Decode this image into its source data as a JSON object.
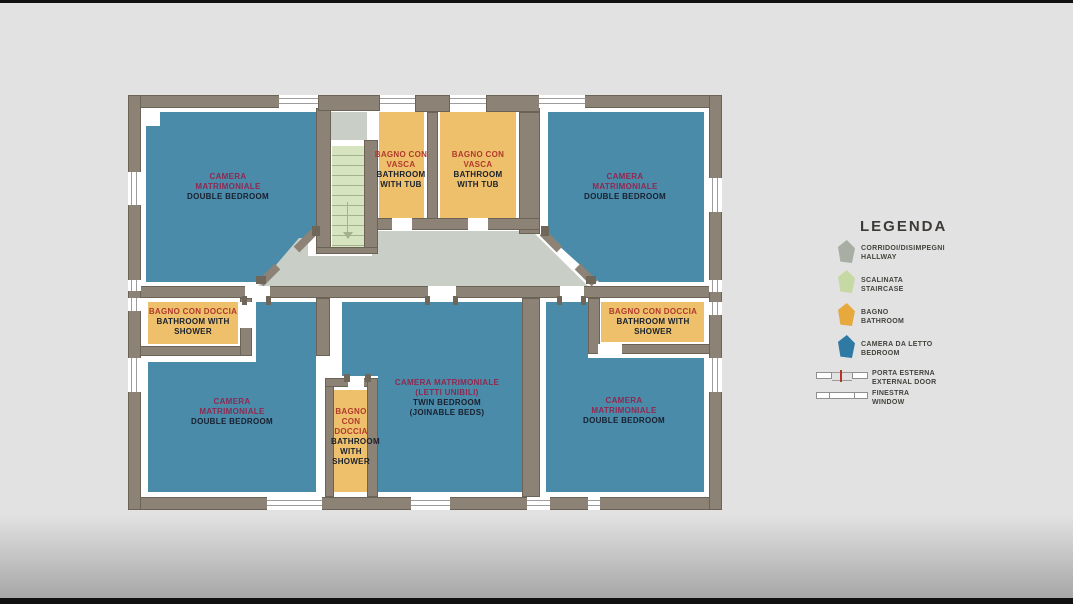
{
  "colors": {
    "bg": "#e2e2e2",
    "wall": "#8c8275",
    "wallline": "#6b6356",
    "bedroom": "#4b8baa",
    "bathroom": "#eec06c",
    "hallway": "#c9cfc7",
    "stair": "#d6e4c0",
    "stairline": "#a2b38d",
    "ink": "#18202e",
    "itblue": "#8e2950",
    "itorange": "#b03a2c",
    "legendink": "#45433e",
    "lghall": "#a8aea3",
    "lgstair": "#c6d9a4",
    "lgbath": "#e7a93e",
    "lgbed": "#2e7aa4",
    "doorred": "#b5342c",
    "winline": "#9d9d9d"
  },
  "rooms": {
    "bedroom_top_left": {
      "lines_it": [
        "CAMERA",
        "MATRIMONIALE"
      ],
      "lines_en": [
        "DOUBLE BEDROOM"
      ]
    },
    "bedroom_top_right": {
      "lines_it": [
        "CAMERA",
        "MATRIMONIALE"
      ],
      "lines_en": [
        "DOUBLE BEDROOM"
      ]
    },
    "bath_tub_left": {
      "lines_it": [
        "BAGNO CON",
        "VASCA"
      ],
      "lines_en": [
        "BATHROOM",
        "WITH TUB"
      ]
    },
    "bath_tub_right": {
      "lines_it": [
        "BAGNO CON",
        "VASCA"
      ],
      "lines_en": [
        "BATHROOM",
        "WITH TUB"
      ]
    },
    "bath_shower_left": {
      "lines_it": [
        "BAGNO CON DOCCIA"
      ],
      "lines_en": [
        "BATHROOM WITH",
        "SHOWER"
      ]
    },
    "bath_shower_right": {
      "lines_it": [
        "BAGNO CON DOCCIA"
      ],
      "lines_en": [
        "BATHROOM WITH",
        "SHOWER"
      ]
    },
    "bath_shower_center": {
      "lines_it": [
        "BAGNO",
        "CON",
        "DOCCIA"
      ],
      "lines_en": [
        "BATHROOM",
        "WITH",
        "SHOWER"
      ]
    },
    "bedroom_bottom_left": {
      "lines_it": [
        "CAMERA",
        "MATRIMONIALE"
      ],
      "lines_en": [
        "DOUBLE BEDROOM"
      ]
    },
    "twin_bedroom": {
      "lines_it": [
        "CAMERA MATRIMONIALE",
        "(LETTI UNIBILI)"
      ],
      "lines_en": [
        "TWIN BEDROOM",
        "(JOINABLE BEDS)"
      ]
    },
    "bedroom_bottom_right": {
      "lines_it": [
        "CAMERA",
        "MATRIMONIALE"
      ],
      "lines_en": [
        "DOUBLE BEDROOM"
      ]
    }
  },
  "legend": {
    "title": "LEGENDA",
    "items": [
      {
        "it": "CORRIDOI/DISIMPEGNI",
        "en": "HALLWAY"
      },
      {
        "it": "SCALINATA",
        "en": "STAIRCASE"
      },
      {
        "it": "BAGNO",
        "en": "BATHROOM"
      },
      {
        "it": "CAMERA DA LETTO",
        "en": "BEDROOM"
      },
      {
        "it": "PORTA ESTERNA",
        "en": "EXTERNAL DOOR"
      },
      {
        "it": "FINESTRA",
        "en": "WINDOW"
      }
    ]
  }
}
